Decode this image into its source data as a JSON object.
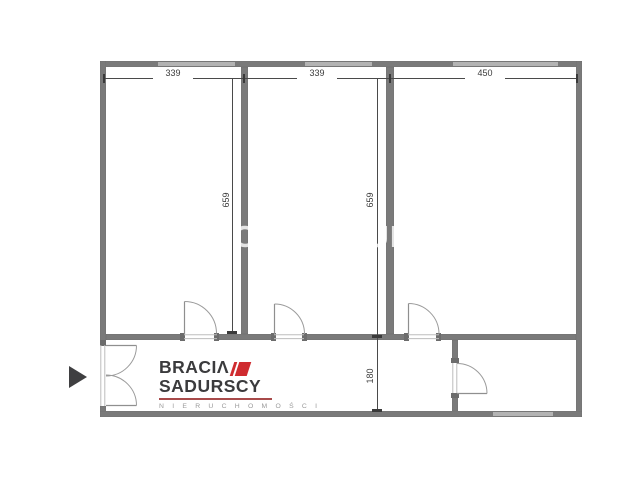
{
  "plan": {
    "type": "floor-plan",
    "dims": {
      "h": [
        "339",
        "339",
        "450"
      ],
      "v": [
        "659",
        "659"
      ],
      "corridor": "180"
    },
    "rooms": [
      {
        "name": "room-1",
        "width_cm": 339,
        "depth_cm": 659
      },
      {
        "name": "room-2",
        "width_cm": 339,
        "depth_cm": 659
      },
      {
        "name": "room-3",
        "width_cm": 450,
        "depth_cm": 659
      },
      {
        "name": "corridor",
        "depth_cm": 180
      },
      {
        "name": "room-bottom-right"
      }
    ],
    "doors": 5,
    "windows": 4,
    "entrance_marker": "right-pointing-triangle"
  },
  "logo": {
    "brand_top": "BRACIΛ",
    "brand_bottom": "SADURSCY",
    "subtitle": "N I E R U C H O M O Ś C I"
  },
  "watermark": "BRACIA SADURSCY",
  "colors": {
    "wall": "#7a7a7a",
    "window": "#b3b3b3",
    "door_line": "#9b9b9b",
    "dimension": "#4a4a4a",
    "logo_text": "#3b3b3d",
    "logo_accent": "#cf2b2f",
    "logo_subtitle": "#9a9a9a",
    "arrow": "#3f3f41"
  }
}
